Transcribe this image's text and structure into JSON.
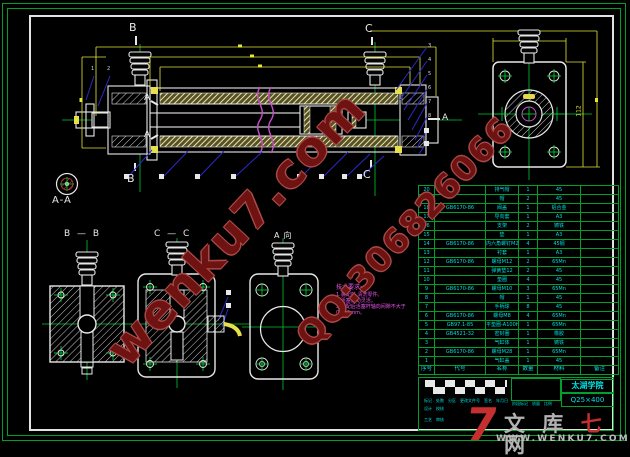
{
  "watermarks": {
    "site": "wenku7.com",
    "qq": "QQ:306826066"
  },
  "logo": {
    "seven": "7",
    "word_pre": "文 库 ",
    "word_red": "七",
    "word_post": " 网",
    "url": "WWW.WENKU7.COM"
  },
  "views": {
    "section_aa_label": "A-A",
    "section_bb_label": "B — B",
    "section_cc_label": "C — C",
    "view_a_label": "A向",
    "marker_b_top": "B",
    "marker_b_bottom": "B",
    "marker_c_top": "C",
    "marker_c_bottom": "C",
    "arrow_a_upper": "A",
    "arrow_a_lower": "A",
    "arrow_a_right": "A"
  },
  "balloons": {
    "left": [
      "1",
      "2"
    ],
    "right": [
      "3",
      "4",
      "5",
      "6",
      "7",
      "8"
    ]
  },
  "dimensions": {
    "flange_height": "112"
  },
  "tech_notes": {
    "title": "技术要求:",
    "lines": [
      "1.装配前,清洗零件。",
      "2.活塞运动灵活。",
      "3.装配后活塞杆轴向间隙不大于",
      "0.025mm。"
    ]
  },
  "bom": {
    "headers": [
      "序号",
      "代号",
      "名称",
      "数量",
      "材料",
      "备注"
    ],
    "rows": [
      [
        "20",
        "",
        "排气帽",
        "1",
        "45",
        ""
      ],
      [
        "19",
        "",
        "帽",
        "2",
        "45",
        ""
      ],
      [
        "18",
        "GB6170-86",
        "阀盖",
        "1",
        "铝合金",
        ""
      ],
      [
        "17",
        "",
        "导向套",
        "1",
        "A3",
        ""
      ],
      [
        "16",
        "",
        "支架",
        "2",
        "铸铁",
        ""
      ],
      [
        "15",
        "",
        "垫",
        "1",
        "A3",
        ""
      ],
      [
        "14",
        "GB6170-86",
        "内六角螺钉M2×70",
        "4",
        "45钢",
        ""
      ],
      [
        "13",
        "",
        "衬套",
        "1",
        "A3",
        ""
      ],
      [
        "12",
        "GB6170-86",
        "螺母M12",
        "2",
        "65Mn",
        ""
      ],
      [
        "11",
        "",
        "弹簧垫12",
        "2",
        "45",
        ""
      ],
      [
        "10",
        "",
        "垫圈",
        "4",
        "45",
        ""
      ],
      [
        "9",
        "GB6170-86",
        "螺母M10",
        "3",
        "65Mn",
        ""
      ],
      [
        "8",
        "",
        "帽",
        "1",
        "45",
        ""
      ],
      [
        "7",
        "",
        "手柄球",
        "8",
        "45",
        ""
      ],
      [
        "6",
        "GB6170-86",
        "螺母M8",
        "4",
        "65Mn",
        ""
      ],
      [
        "5",
        "GB97.1-85",
        "平垫圈-A100HV",
        "1",
        "65Mn",
        ""
      ],
      [
        "4",
        "GB4521-32",
        "密封圈",
        "1",
        "橡胶",
        ""
      ],
      [
        "3",
        "",
        "气缸体",
        "1",
        "铸铁",
        ""
      ],
      [
        "2",
        "GB6170-86",
        "螺母M28",
        "1",
        "65Mn",
        ""
      ],
      [
        "1",
        "",
        "气缸盖",
        "1",
        "45",
        ""
      ]
    ]
  },
  "title_block": {
    "school": "太湖学院",
    "drawing_no": "Q25×400",
    "revision_row": [
      "标记",
      "处数",
      "分区",
      "更改文件号",
      "签名",
      "年月日"
    ],
    "sign_row_1": [
      "设计",
      "校核"
    ],
    "sign_row_2": [
      "工艺",
      "审核"
    ],
    "stage_row": [
      "阶段标记",
      "质量",
      "比例"
    ]
  }
}
